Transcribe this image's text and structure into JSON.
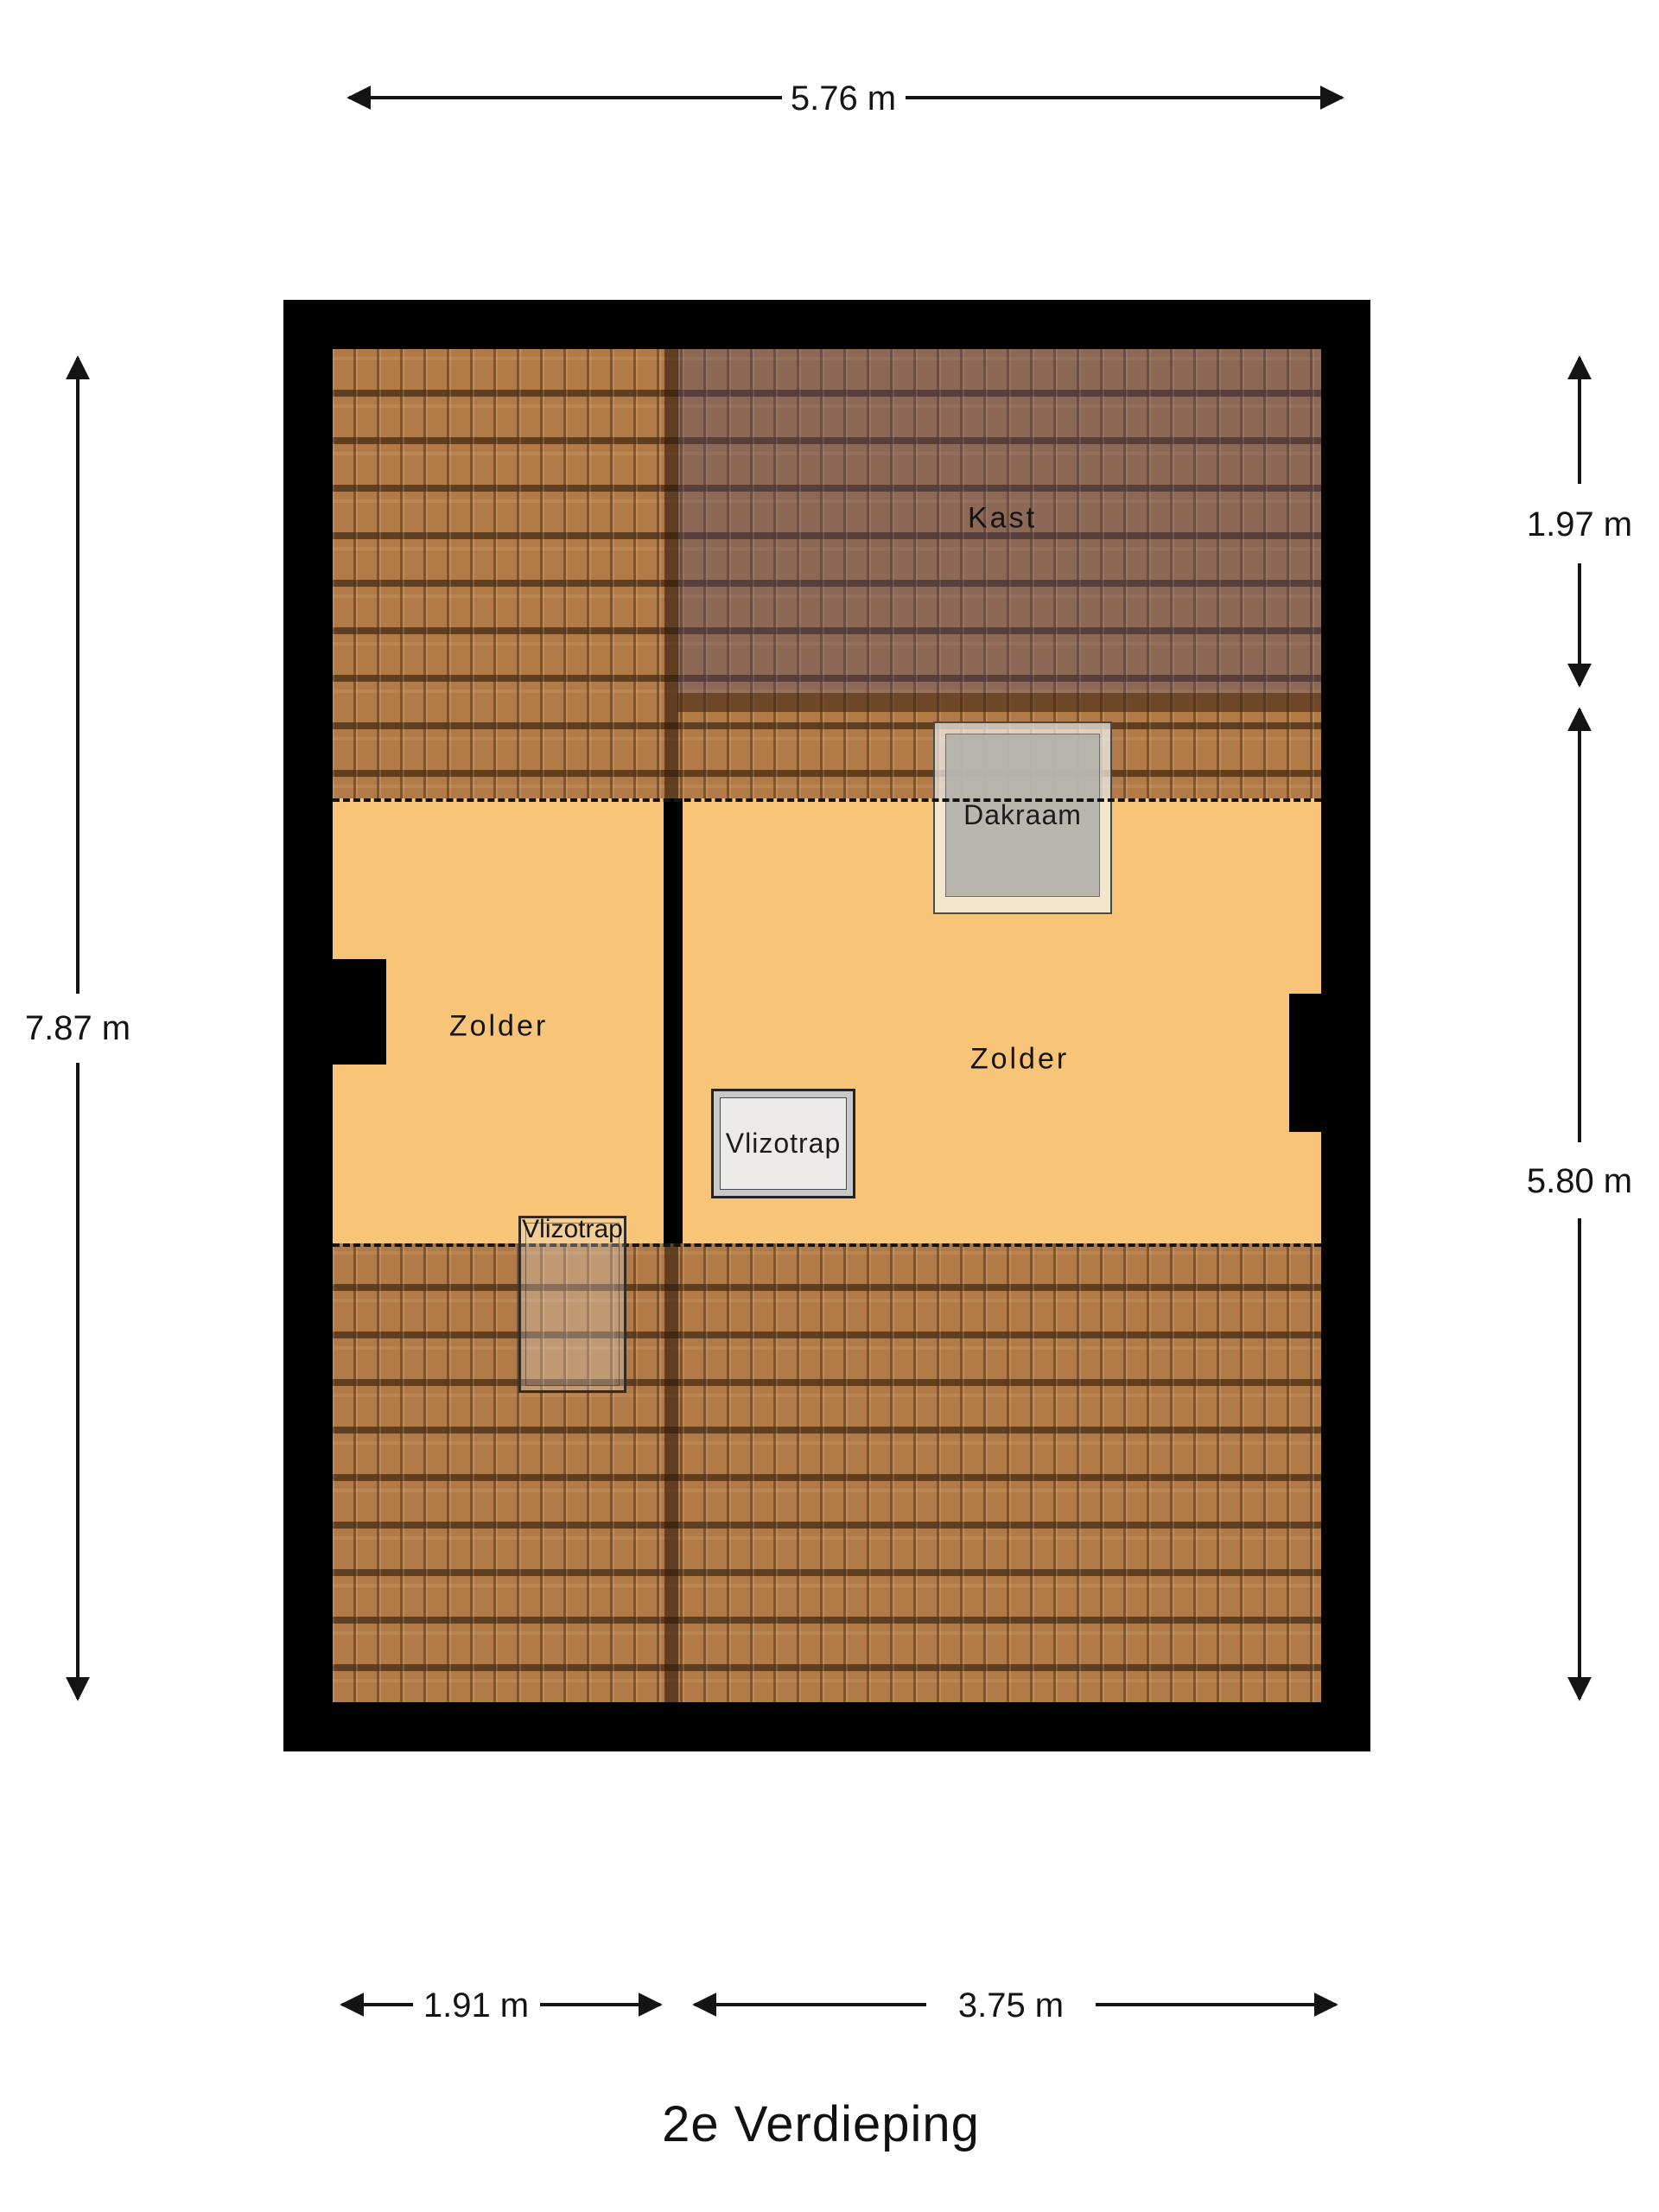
{
  "floor_label": "2e Verdieping",
  "rooms": {
    "kast": "Kast",
    "zolder_left": "Zolder",
    "zolder_right": "Zolder"
  },
  "fixtures": {
    "dakraam": "Dakraam",
    "vlizotrap_right": "Vlizotrap",
    "vlizotrap_left": "Vlizotrap"
  },
  "dimensions": {
    "top_width": "5.76 m",
    "left_height": "7.87 m",
    "right_upper": "1.97 m",
    "right_lower": "5.80 m",
    "bottom_left": "1.91 m",
    "bottom_right": "3.75 m"
  },
  "colors": {
    "wall": "#000000",
    "floor": "#f8c578",
    "roof_tile": "#b17a46",
    "dimension_text": "#141414"
  }
}
